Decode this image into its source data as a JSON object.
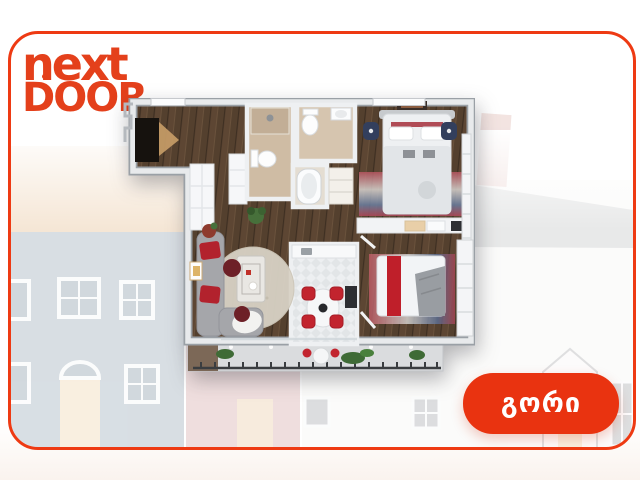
{
  "brand": {
    "logo_line1": "next",
    "logo_line2": "DOOR",
    "color": "#e4401b"
  },
  "card": {
    "border_color": "#ee3a13",
    "background": "#ffffff",
    "corner_radius_px": 30
  },
  "city_button": {
    "label": "გორი",
    "background_color": "#e93310",
    "text_color": "#ffffff"
  },
  "floorplan": {
    "kind": "3d-top-down-apartment-render",
    "palette": {
      "wood_floor": "#5d4633",
      "walls_light": "#e8eaec",
      "walls_shadow": "#9aa0a6",
      "bathroom_tile": "#cfbca4",
      "kitchen_tile": "#edeff1",
      "accent_red": "#c0202b",
      "sofa_gray": "#a5a6aa",
      "navy_chair": "#333f5d",
      "balcony_gray": "#dadcde",
      "plant_green": "#47703b"
    }
  },
  "background_art": {
    "kind": "faded-hand-painted-row-houses",
    "opacity": 0.3,
    "palette": {
      "roof_tan": "#dfae77",
      "house_blue": "#7f95a6",
      "house_pink": "#cd9495",
      "house_white": "#f4f2f0",
      "roof_gray": "#b4b7ba",
      "chimney_pink": "#d6a69d",
      "door_tan": "#ecc999",
      "window_frame_white": "#f4f6f8"
    }
  }
}
